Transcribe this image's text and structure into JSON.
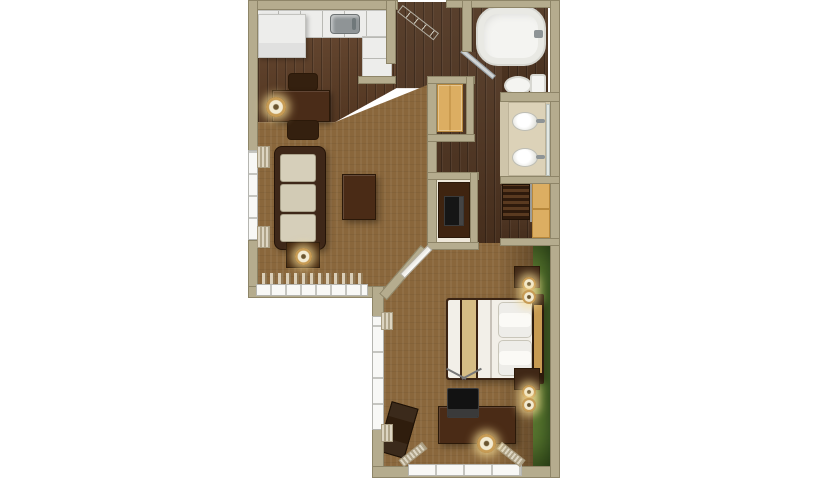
{
  "meta": {
    "kind": "3d-rendered floor plan, top-down view, one-bedroom suite",
    "canvas": {
      "width": 815,
      "height": 480
    },
    "background": "#ffffff"
  },
  "palette": {
    "wall_tan": "#b5ac8e",
    "wall_edge": "#8e8568",
    "wood_floor_dark": "#4f3420",
    "wood_floor_kitchen": "#5e3e26",
    "carpet_brown": "#8a673c",
    "accent_wall_green": "#4e6b2a",
    "accent_wall_green_dark": "#324c1e",
    "fixture_white": "#f4f4f1",
    "counter_white": "#ededeb",
    "furniture_dark_wood": "#472a17",
    "closet_shelf_tan": "#dcae62",
    "sofa_cushion_cream": "#d6cfba",
    "bed_runner_tan": "#d6bd85",
    "headboard_gold": "#c79b52",
    "vanity_floor_beige": "#cfc5aa",
    "lamp_glow": "#f6eed6"
  },
  "rooms": [
    {
      "name": "kitchen",
      "floor": "dark wood"
    },
    {
      "name": "living-room",
      "floor": "brown carpet"
    },
    {
      "name": "entry-hall",
      "floor": "dark wood"
    },
    {
      "name": "bathroom-tub-toilet",
      "floor": "dark wood"
    },
    {
      "name": "vanity-area",
      "floor": "beige"
    },
    {
      "name": "entry-closet",
      "floor": "wood"
    },
    {
      "name": "bedroom-closet",
      "floor": "wood"
    },
    {
      "name": "bedroom",
      "floor": "brown carpet",
      "accent": "green painted wall on right side"
    }
  ],
  "furniture": {
    "kitchen": [
      "refrigerator",
      "l-shaped-counter",
      "stainless-sink",
      "dining-table",
      "two-chairs",
      "table-lamp"
    ],
    "living_room": [
      "three-seat-sofa",
      "coffee-table",
      "end-table",
      "end-table-lamp",
      "tv-niche-console",
      "left-window",
      "bottom-window"
    ],
    "bathroom": [
      "bathtub",
      "glass-door",
      "toilet",
      "double-sink-vanity",
      "mirror"
    ],
    "closets": [
      "entry-closet-shelves",
      "bedroom-closet-hanging-clothes",
      "bedroom-closet-shelves"
    ],
    "bedroom": [
      "queen-bed-white-duvet-tan-runner",
      "gold-headboard",
      "nightstand-top",
      "nightstand-bottom",
      "four-small-lamps",
      "desk",
      "crt-tv-with-antenna",
      "floor-lamp",
      "luggage-bench",
      "left-window",
      "bottom-window"
    ],
    "doors": [
      "entry-door-open",
      "bathroom-door-open",
      "bedroom-door-open-on-diagonal-wall"
    ]
  }
}
